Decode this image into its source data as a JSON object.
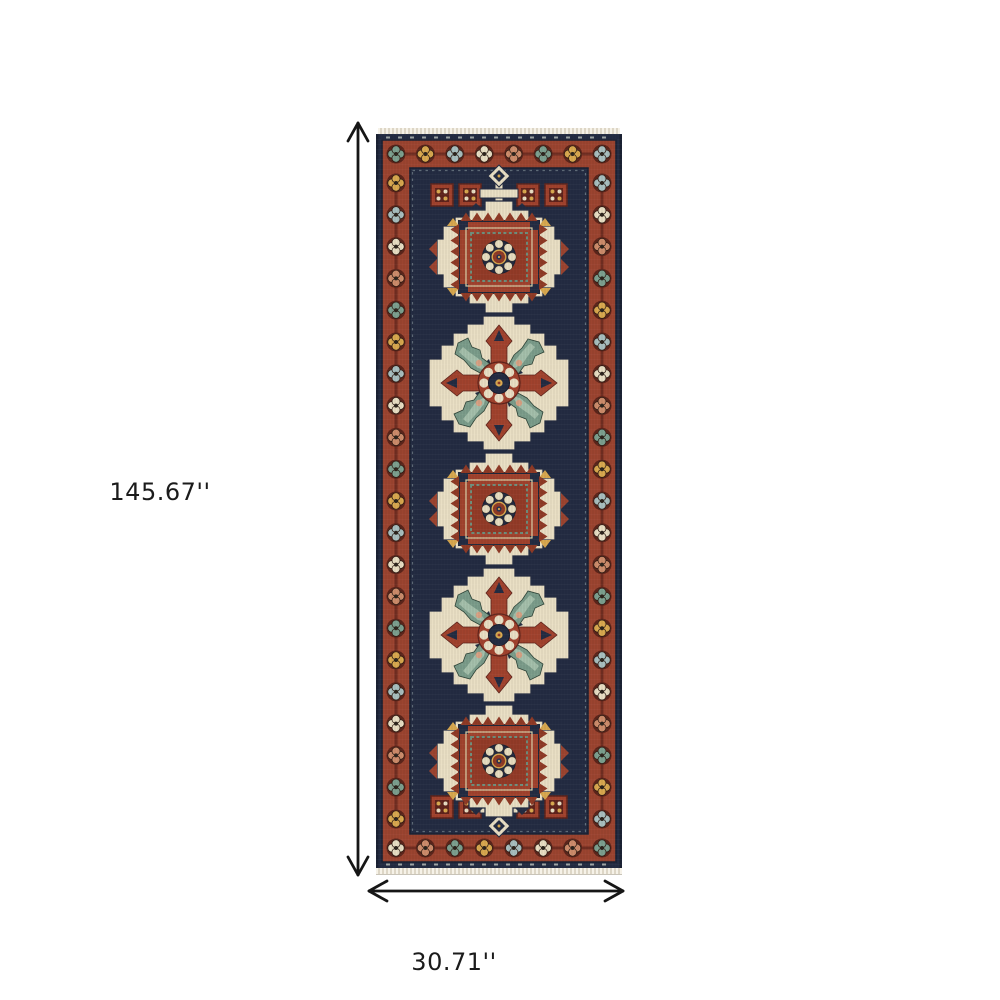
{
  "page": {
    "background": "#ffffff",
    "description": "Dimension diagram of an oriental runner rug"
  },
  "dimensions": {
    "height": {
      "label": "145.67''"
    },
    "width": {
      "label": "30.71''"
    }
  },
  "arrows": {
    "color": "#161616",
    "vertical_icon": "double-headed-vertical-arrow",
    "horizontal_icon": "double-headed-horizontal-arrow"
  },
  "product": {
    "name": "navy-and-rust-oriental-runner-rug",
    "style": "geometric medallion runner with flowered border and fringe",
    "colors": {
      "navy": "#242c42",
      "navy_dark": "#1a2133",
      "rust": "#9c4430",
      "rust_bright": "#a1422d",
      "maroon": "#5f241c",
      "ivory": "#e9dfc4",
      "gold": "#d9a94f",
      "teal": "#7ca08f",
      "pale_blue": "#a9bfbf",
      "salmon": "#cd8c6b",
      "mint": "#abc6b0",
      "fringe": "#efe9db"
    }
  },
  "rug": {
    "medallion_count": 5,
    "border_flowers": {
      "palette": [
        "#7ca08f",
        "#d9a94f",
        "#a9bfbf",
        "#e9dfc4",
        "#cd8c6b"
      ]
    },
    "medallions": [
      {
        "type": "square",
        "y": 130
      },
      {
        "type": "star",
        "y": 256
      },
      {
        "type": "square",
        "y": 382
      },
      {
        "type": "star",
        "y": 508
      },
      {
        "type": "square",
        "y": 634
      }
    ],
    "pendants": [
      {
        "y": 66,
        "flip": false
      },
      {
        "y": 682,
        "flip": true
      }
    ],
    "guls": [
      [
        66,
        68
      ],
      [
        94,
        68
      ],
      [
        152,
        68
      ],
      [
        180,
        68
      ],
      [
        66,
        680
      ],
      [
        94,
        680
      ],
      [
        152,
        680
      ],
      [
        180,
        680
      ]
    ]
  }
}
